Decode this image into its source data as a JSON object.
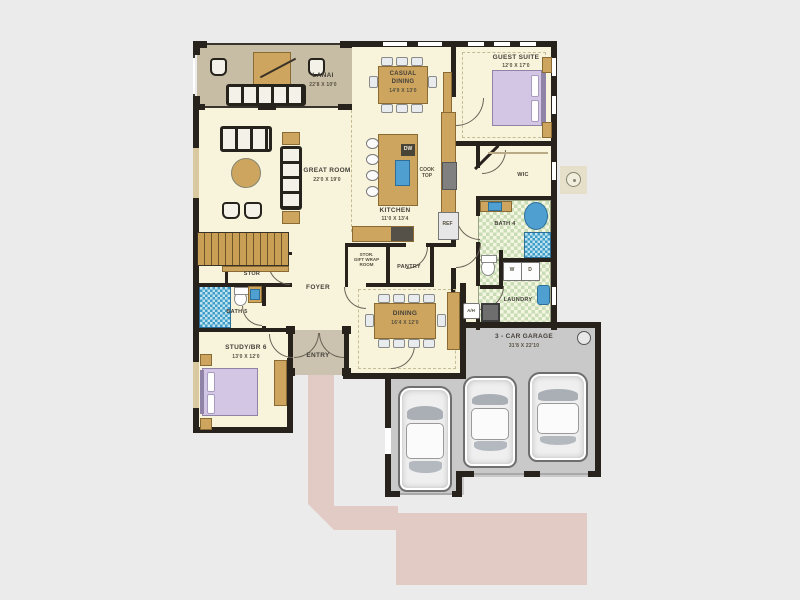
{
  "plan": {
    "title": "single-story floor plan with 3-car garage",
    "rooms": {
      "lanai": {
        "label": "LANAI",
        "dims": "22'8 X 10'0"
      },
      "great_room": {
        "label": "GREAT ROOM",
        "dims": "22'0 X 19'0"
      },
      "casual_dining": {
        "label": "CASUAL DINING",
        "dims": "14'9 X 13'0"
      },
      "kitchen": {
        "label": "KITCHEN",
        "dims": "11'0 X 13'4"
      },
      "guest_suite": {
        "label": "GUEST SUITE",
        "dims": "12'0 X 17'0"
      },
      "wic": {
        "label": "WIC"
      },
      "bath4": {
        "label": "BATH 4"
      },
      "laundry": {
        "label": "LAUNDRY"
      },
      "pantry": {
        "label": "PANTRY"
      },
      "stor_gift": {
        "line1": "STOR.",
        "line2": "GIFT WRAP",
        "line3": "ROOM"
      },
      "dining": {
        "label": "DINING",
        "dims": "16'4 X 12'0"
      },
      "foyer": {
        "label": "FOYER"
      },
      "stor": {
        "label": "STOR"
      },
      "bath5": {
        "label": "BATH 5"
      },
      "study": {
        "label": "STUDY/BR 6",
        "dims": "13'0 X 12'0"
      },
      "entry": {
        "label": "ENTRY"
      },
      "garage": {
        "label": "3 - CAR GARAGE",
        "dims": "31'8 X 22'10"
      }
    },
    "appliances": {
      "dw": "DW",
      "cooktop": "COOK TOP",
      "ref": "REF",
      "washer": "W",
      "dryer": "D",
      "ahu": "A/H"
    },
    "colors": {
      "background": "#ebebeb",
      "floor_cream": "#f8f4dc",
      "lanai_taupe": "#c7bca4",
      "wall_dark": "#27221c",
      "wood_tan": "#cda55f",
      "garage_gray": "#c9c9c9",
      "driveway_pink": "#e2cbc5",
      "bed_lavender": "#d3c6e4",
      "fixture_blue": "#4f9fd0",
      "tile_green": "#c8dcb6",
      "tile_blue": "#3e9dc8"
    }
  }
}
